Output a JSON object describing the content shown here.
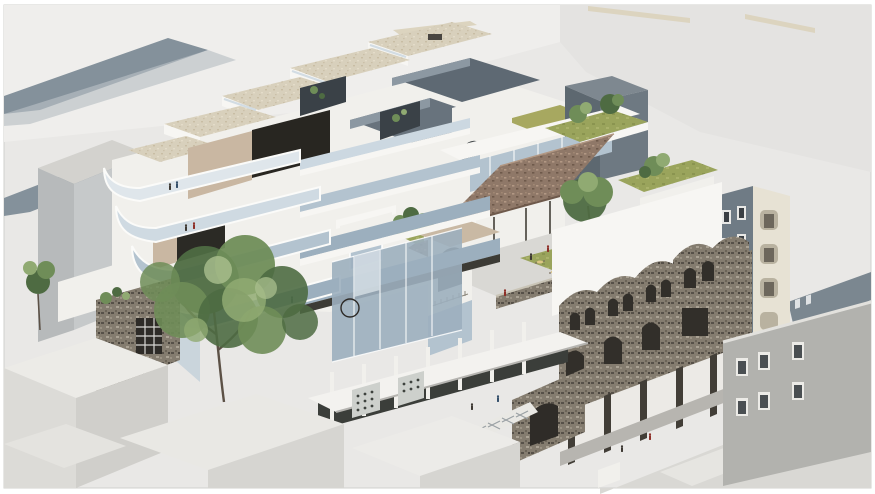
{
  "image": {
    "kind": "architectural-axonometric-render",
    "description": "Aerial cutaway rendering of an urban infill block: stepped glass section floors at left, travertine roof decks with planters, a central rooftop courtyard garden with cafe tables and a terracotta canopy, white arched pavilions and loggias, a preserved weathered stone heritage facade propped on dark posts at right, surrounded by pale abstract context buildings, foreground hip-roof houses, a street arcade with white canopy and a large green tree."
  },
  "palette": {
    "bg": "#e9e8e6",
    "bgLight": "#efeeec",
    "bgMass": "#e4e3e1",
    "whiteTop": "#f7f6f3",
    "whiteFace": "#f1f0ec",
    "whiteShade": "#dededa",
    "slabShadow": "#c7c6c2",
    "glassLight": "#ccd8e1",
    "glassMid": "#b3c3cf",
    "glassDark": "#9cafbe",
    "glassPale": "#dfe6eb",
    "beige": "#c9b7a2",
    "tanDeck": "#d8d0bc",
    "darkOpen": "#282621",
    "voidSlate": "#5e6973",
    "voidSlateLight": "#8c98a2",
    "slateTower": "#5d6870",
    "slateTowerSide": "#6e7982",
    "streetShadow": "#84919b",
    "lawn": "#9aa45c",
    "lawnOlive": "#a7a860",
    "treeDark": "#4e6b42",
    "treeMid": "#6f8d58",
    "treeLight": "#90aa72",
    "treeHi": "#aabf8e",
    "canopy": "#8f7868",
    "canopyHi": "#b29884",
    "canopyLo": "#6e594b",
    "stone": "#847c6f",
    "stoneDark": "#575149",
    "stoneLight": "#aaa294",
    "post": "#423e37",
    "shopGray": "#6f7b85",
    "cream": "#e7e2d4",
    "creamShade": "#b9b2a0",
    "grayWall": "#b2b2ae",
    "grayWallTop": "#d3d2ce",
    "street": "#d9d8d4",
    "sidewalk": "#e6e5e1",
    "figDark": "#3e3933",
    "figRed": "#8e2f28",
    "figBlue": "#35506b",
    "frame": "#d0d0ce"
  },
  "scene": {
    "regions": [
      {
        "name": "context-roofs-top-left",
        "label": "pale background roofs with shadowed street canyons"
      },
      {
        "name": "roof-deck-cluster",
        "label": "staggered travertine roof decks with glass rails and planters"
      },
      {
        "name": "courtyard-voids",
        "label": "deep slate-toned lightwells between roof slabs"
      },
      {
        "name": "cutaway-wing",
        "label": "sectioned wing with cascading curved floor plates and figures"
      },
      {
        "name": "glass-curtain-hall",
        "label": "white framed glass box over open colonnade"
      },
      {
        "name": "terracotta-canopy",
        "label": "speckled tiled canopy on slender columns"
      },
      {
        "name": "garden-terrace",
        "label": "rooftop lawn with trees, cafe tables and visitors"
      },
      {
        "name": "arched-pavilions",
        "label": "white arched parapet towers and loggia with balustrade"
      },
      {
        "name": "heritage-facade",
        "label": "weathered stone gabled facade retained on dark posts"
      },
      {
        "name": "shophouses",
        "label": "gray and cream narrow shophouse facades"
      },
      {
        "name": "right-gray-building",
        "label": "gray corner building with white framed windows"
      },
      {
        "name": "street-arcade",
        "label": "street level arcade, white canopy, lattice screens"
      },
      {
        "name": "foreground-houses",
        "label": "low white hip-roofed houses"
      },
      {
        "name": "large-tree",
        "label": "large green street tree"
      }
    ]
  }
}
